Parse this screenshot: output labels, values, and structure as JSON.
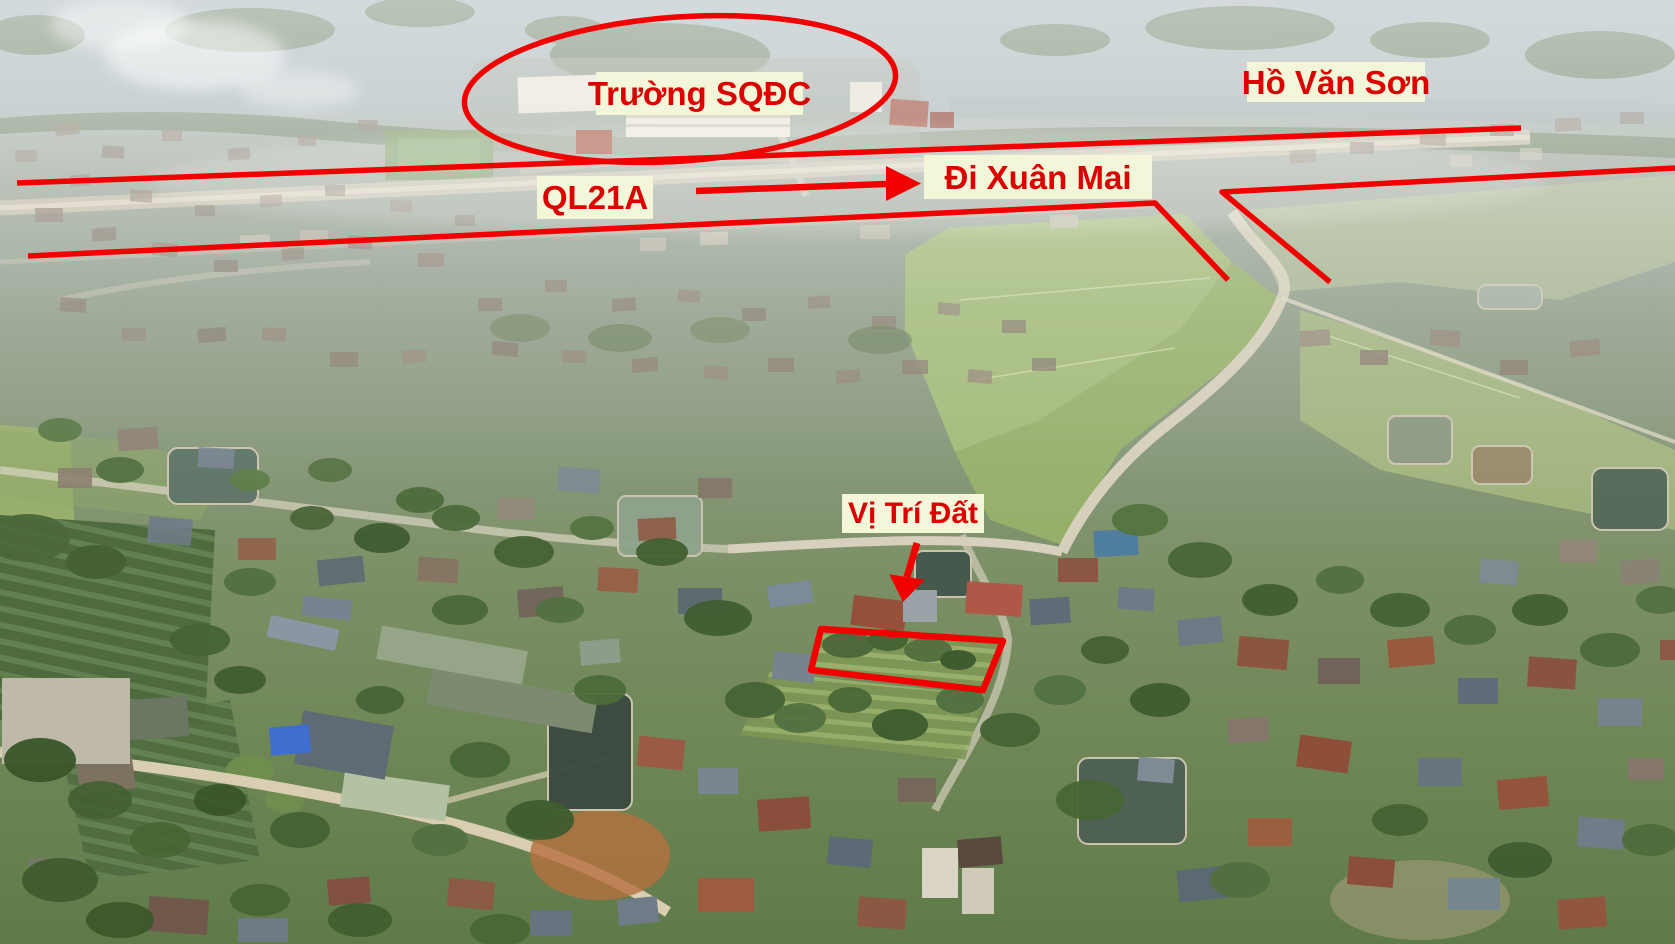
{
  "annotations": {
    "labels": [
      {
        "id": "truong-sqdc",
        "text": "Trường SQĐC"
      },
      {
        "id": "ho-van-son",
        "text": "Hồ Văn Sơn"
      },
      {
        "id": "ql21a",
        "text": "QL21A"
      },
      {
        "id": "di-xuan-mai",
        "text": "Đi Xuân Mai"
      },
      {
        "id": "vi-tri-dat",
        "text": "Vị Trí Đất"
      }
    ],
    "colors": {
      "annotation_red": "#f20000",
      "label_text_red": "#dc0000",
      "label_background": "#f3f6d8"
    }
  }
}
